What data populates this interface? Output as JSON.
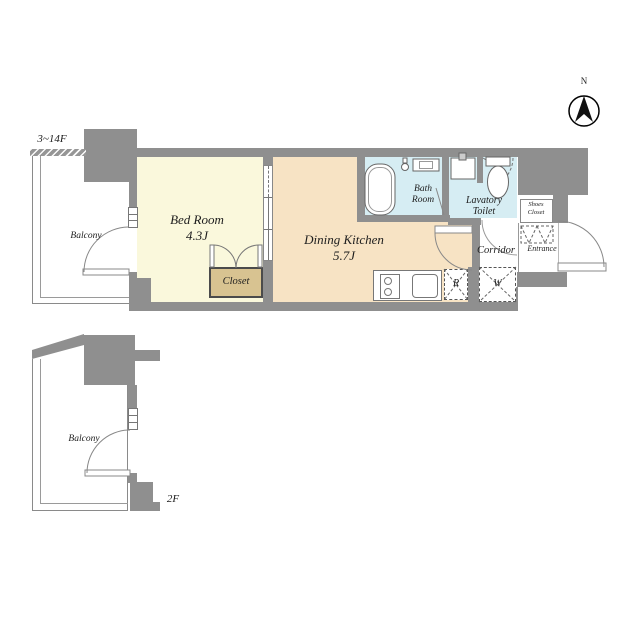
{
  "floor_plan": {
    "unit_floors_label": "3~14F",
    "lower_plan_label": "2F",
    "compass_north_label": "N",
    "rooms": {
      "balcony_main": "Balcony",
      "balcony_lower": "Balcony",
      "bedroom_name": "Bed Room",
      "bedroom_size": "4.3J",
      "dining_kitchen_name": "Dining Kitchen",
      "dining_kitchen_size": "5.7J",
      "closet": "Closet",
      "bath_line1": "Bath",
      "bath_line2": "Room",
      "lavatory_line1": "Lavatory",
      "lavatory_line2": "Toilet",
      "corridor": "Corridor",
      "entrance": "Entrance",
      "shoes_closet_line1": "Shoes",
      "shoes_closet_line2": "Closet",
      "refrigerator_mark": "R",
      "washing_machine_mark": "W"
    },
    "colors": {
      "wall": "#8f8f8f",
      "bedroom_floor": "#faf8dc",
      "dining_kitchen_floor": "#f7e3c4",
      "wet_area_floor": "#d6edf3",
      "closet_fill": "#d8c391"
    }
  }
}
